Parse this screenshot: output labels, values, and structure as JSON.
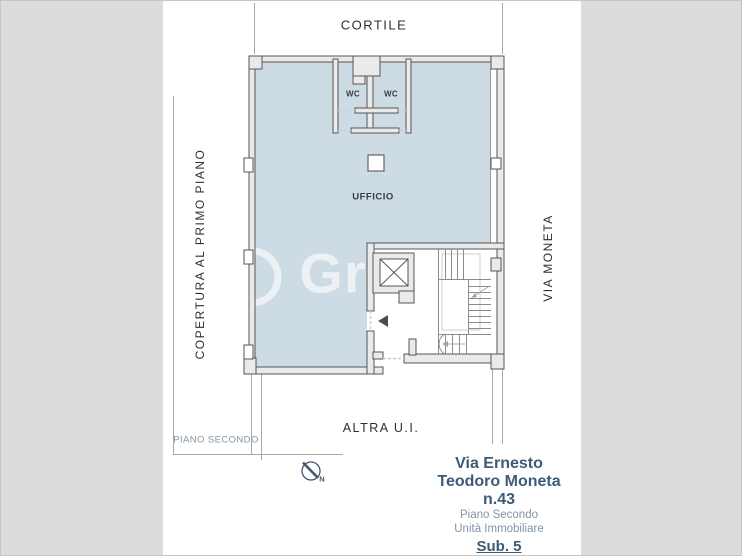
{
  "plan": {
    "labels": {
      "cortile": "CORTILE",
      "copertura": "COPERTURA AL PRIMO PIANO",
      "via_moneta": "VIA MONETA",
      "altra_ui": "ALTRA U.I.",
      "piano_secondo": "PIANO SECONDO",
      "ufficio": "UFFICIO",
      "wc_left": "WC",
      "wc_right": "WC"
    },
    "compass_north": "N",
    "watermark": "Gr"
  },
  "title_block": {
    "address_line1": "Via Ernesto",
    "address_line2": "Teodoro Moneta",
    "address_line3": "n.43",
    "floor": "Piano Secondo",
    "unit": "Unità Immobiliare",
    "subaltern": "Sub. 5"
  },
  "colors": {
    "room_fill": "#ccdbe4",
    "wall_fill": "#eaeaea",
    "wall_stroke": "#565656",
    "side_band": "#dcdcdc",
    "boundary_line": "#a9a9a9",
    "door_dash": "#c3ced7",
    "title_dark": "#3d5a77",
    "title_light": "#8194a9",
    "compass": "#44586c",
    "plan_text": "#2f2f2f"
  }
}
